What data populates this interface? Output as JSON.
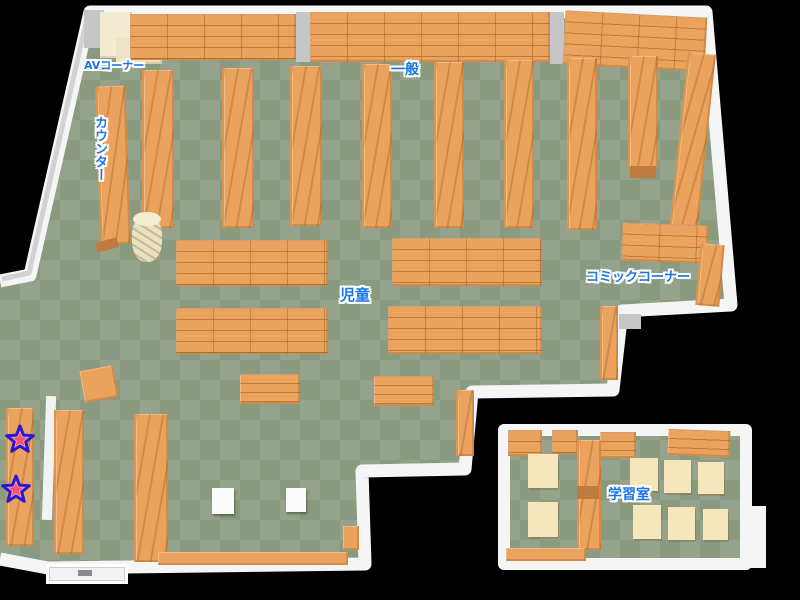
{
  "map": {
    "type": "library-floor-map",
    "labels": {
      "av_corner": "AVコーナー",
      "counter": "カウンター",
      "general": "一般",
      "children": "児童",
      "comic_corner": "コミックコーナー",
      "study_room": "学習室"
    },
    "markers": {
      "icon": "star",
      "count": 2,
      "fill": "#ffaab6",
      "inner_fill": "#f4566e",
      "stroke": "#2a17d6"
    },
    "palette": {
      "background": "#000000",
      "floor_light": "#95a38d",
      "floor_dark": "#899a7f",
      "shelf": "#eba25c",
      "shelf_line": "#b97f41",
      "wall": "#f5f5f5",
      "wall_shadow": "#c6c6c6",
      "cream_furniture": "#f2ebd1",
      "study_table": "#f6e6bb",
      "label_text": "#1b76e8"
    }
  }
}
